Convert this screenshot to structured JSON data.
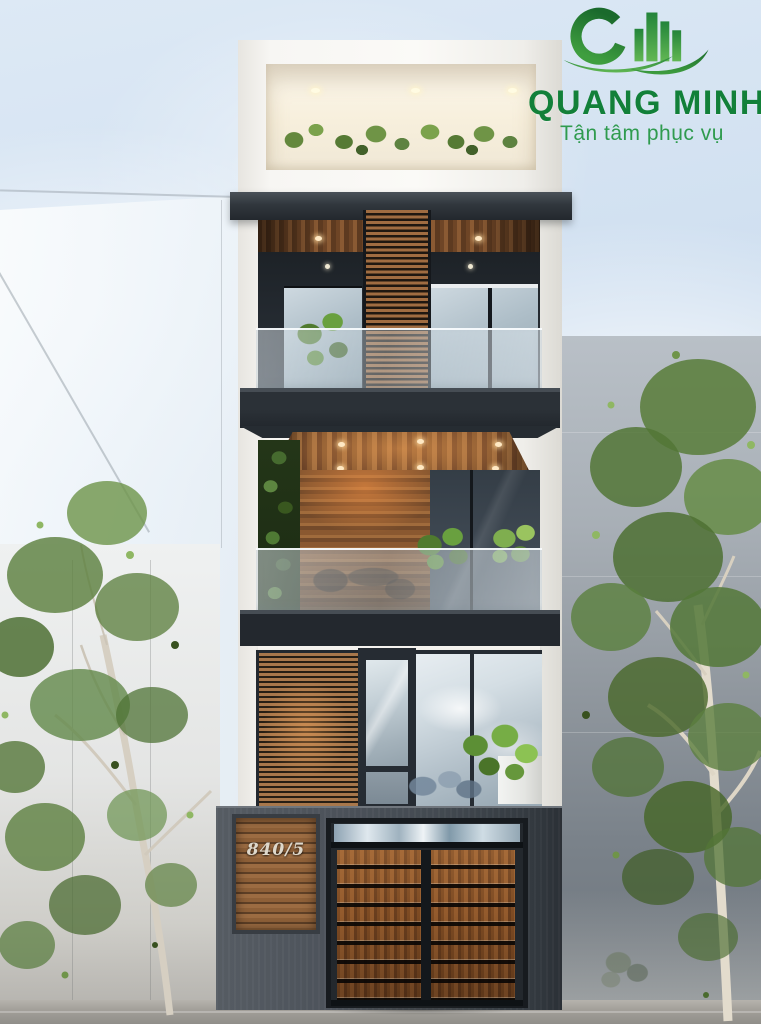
{
  "brand": {
    "name": "QUANG MINH",
    "tagline": "Tận tâm phục vụ",
    "logo_icon": "qm-buildings-swoosh",
    "color_primary": "#128039",
    "color_secondary": "#2f9b4e"
  },
  "house": {
    "number": "840/5"
  },
  "palette": {
    "brand_green": "#128039",
    "brand_green_light": "#2f9b4e",
    "charcoal": "#23282e",
    "fence": "#4c525a",
    "wood": "#8a5a31",
    "gate_wood": "#7e4b23",
    "glass": "#b5c2cb",
    "white_wall": "#f7f6f3",
    "foliage": "#5d8040",
    "sky": "#d7e4f1",
    "street": "#a3a09a"
  }
}
